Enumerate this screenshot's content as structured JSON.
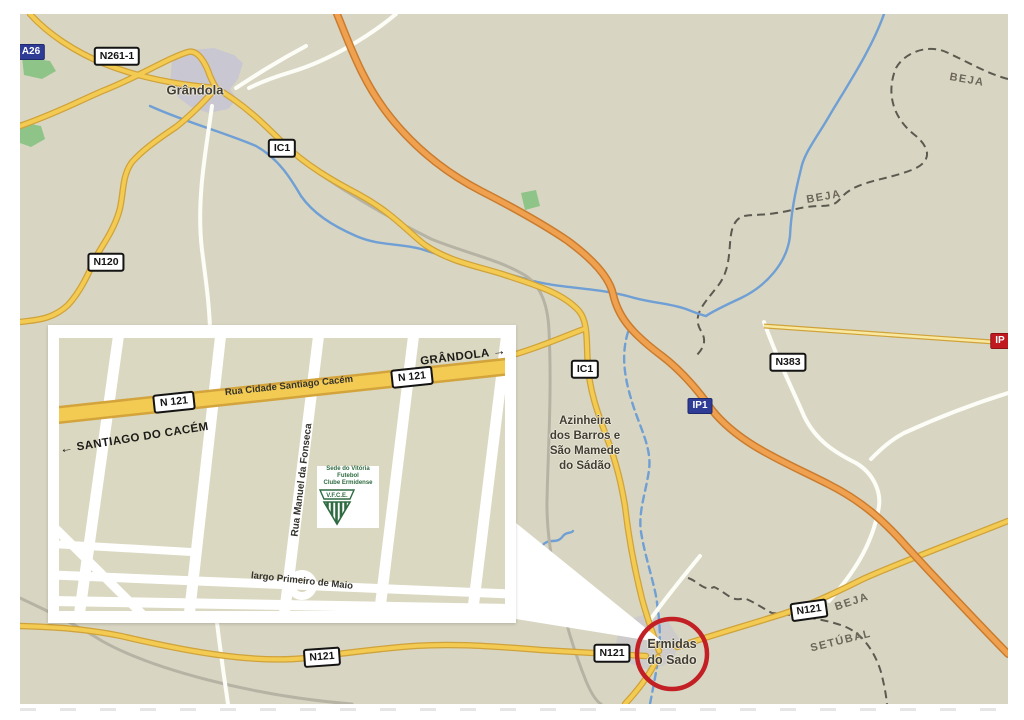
{
  "map": {
    "towns": {
      "grandola": "Grândola",
      "azinheira_lines": [
        "Azinheira",
        "dos Barros e",
        "São Mamede",
        "do Sádão"
      ],
      "ermidas_lines": [
        "Ermidas",
        "do Sado"
      ]
    },
    "regions": {
      "beja_top": "BEJA",
      "beja_mid": "BEJA",
      "beja_bottom": "BEJA",
      "setubal": "SETÚBAL"
    },
    "road_badges": {
      "a26": "A26",
      "n261_1": "N261-1",
      "n120": "N120",
      "ic1_north": "IC1",
      "ic1_south": "IC1",
      "n383": "N383",
      "ip1": "IP1",
      "ip_edge": "IP",
      "n121_west": "N121",
      "n121_center": "N121",
      "n121_east": "N121"
    },
    "colors": {
      "map_background": "#d8d6c2",
      "motorway_orange": "#efa14f",
      "main_road_yellow": "#f3cb52",
      "river_blue": "#6f9fd4",
      "boundary_gray": "#5c5a50",
      "highlight_circle_red": "#c32025",
      "motorway_badge_navy": "#2e3c96",
      "ip_badge_red": "#c01a20"
    }
  },
  "inset": {
    "road_badges": {
      "n121_left": "N 121",
      "n121_right": "N 121"
    },
    "street_names": {
      "rua_cidade": "Rua Cidade Santiago Cacém",
      "rua_manuel": "Rua Manuel da Fonseca",
      "largo": "largo Primeiro de Maio"
    },
    "directions": {
      "grandola": "GRÂNDOLA",
      "santiago": "SANTIAGO DO CACÉM"
    },
    "icons": {
      "arrow_left": "←",
      "arrow_right": "→"
    },
    "logo": {
      "line1": "Sede do Vitória Futebol",
      "line2": "Clube Ermidense",
      "initials": "V.F.C.E."
    }
  }
}
